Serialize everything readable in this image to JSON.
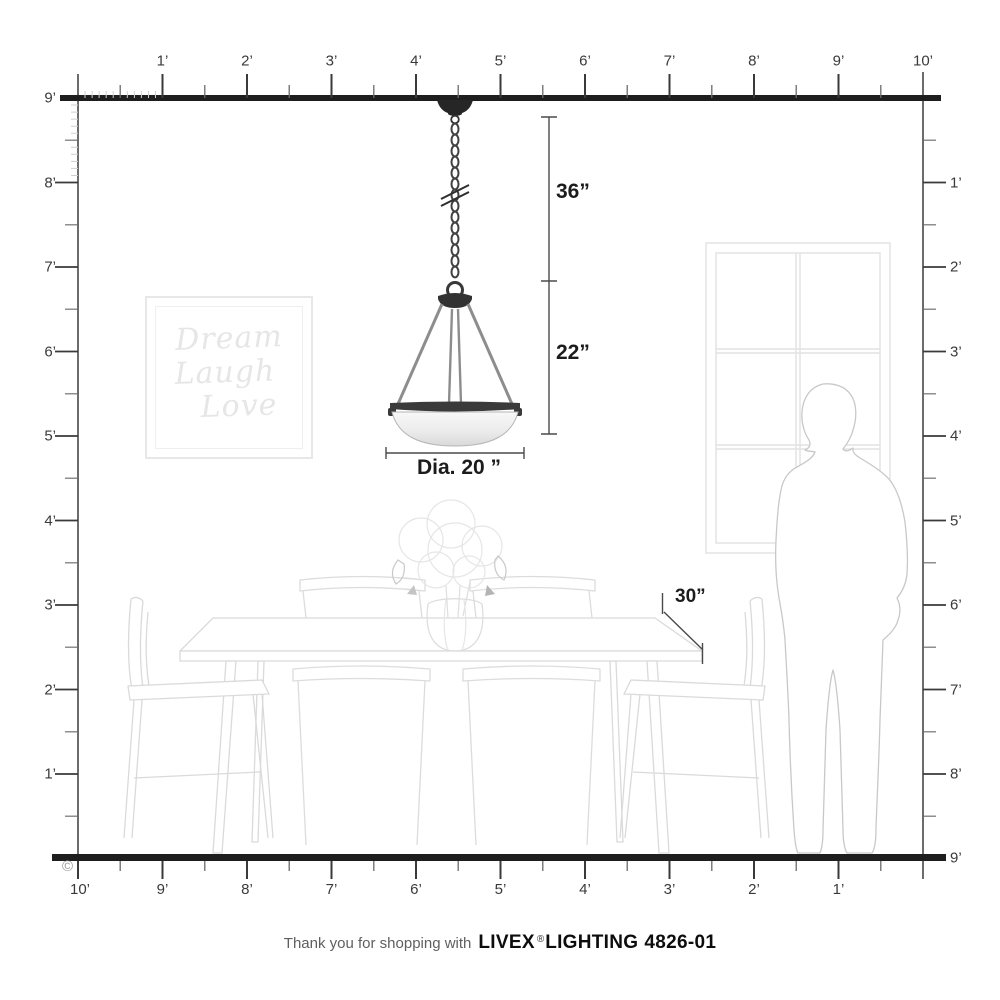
{
  "rulers": {
    "top": [
      "1’",
      "2’",
      "3’",
      "4’",
      "5’",
      "6’",
      "7’",
      "8’",
      "9’",
      "10’"
    ],
    "left": [
      "9’",
      "8’",
      "7’",
      "6’",
      "5’",
      "4’",
      "3’",
      "2’",
      "1’"
    ],
    "right": [
      "1’",
      "2’",
      "3’",
      "4’",
      "5’",
      "6’",
      "7’",
      "8’",
      "9’"
    ],
    "bottom": [
      "10’",
      "9’",
      "8’",
      "7’",
      "6’",
      "5’",
      "4’",
      "3’",
      "2’",
      "1’"
    ]
  },
  "dimensions": {
    "chain_drop": "36”",
    "fixture_height": "22”",
    "shade_diameter": "Dia. 20 ”",
    "table_depth": "30”"
  },
  "wall_art": {
    "line1": "Dream",
    "line2": "Laugh",
    "line3": "Love"
  },
  "footer": {
    "prefix": "Thank you for shopping with",
    "brand": "LIVEX",
    "registered": "®",
    "brand_suffix": "LIGHTING",
    "model": "4826-01"
  },
  "copyright": "©",
  "colors": {
    "ink": "#1e1e1e",
    "label_gray": "#3a3a3a",
    "sketch_faint": "#dedede",
    "metal_gray": "#8d8d8d"
  }
}
